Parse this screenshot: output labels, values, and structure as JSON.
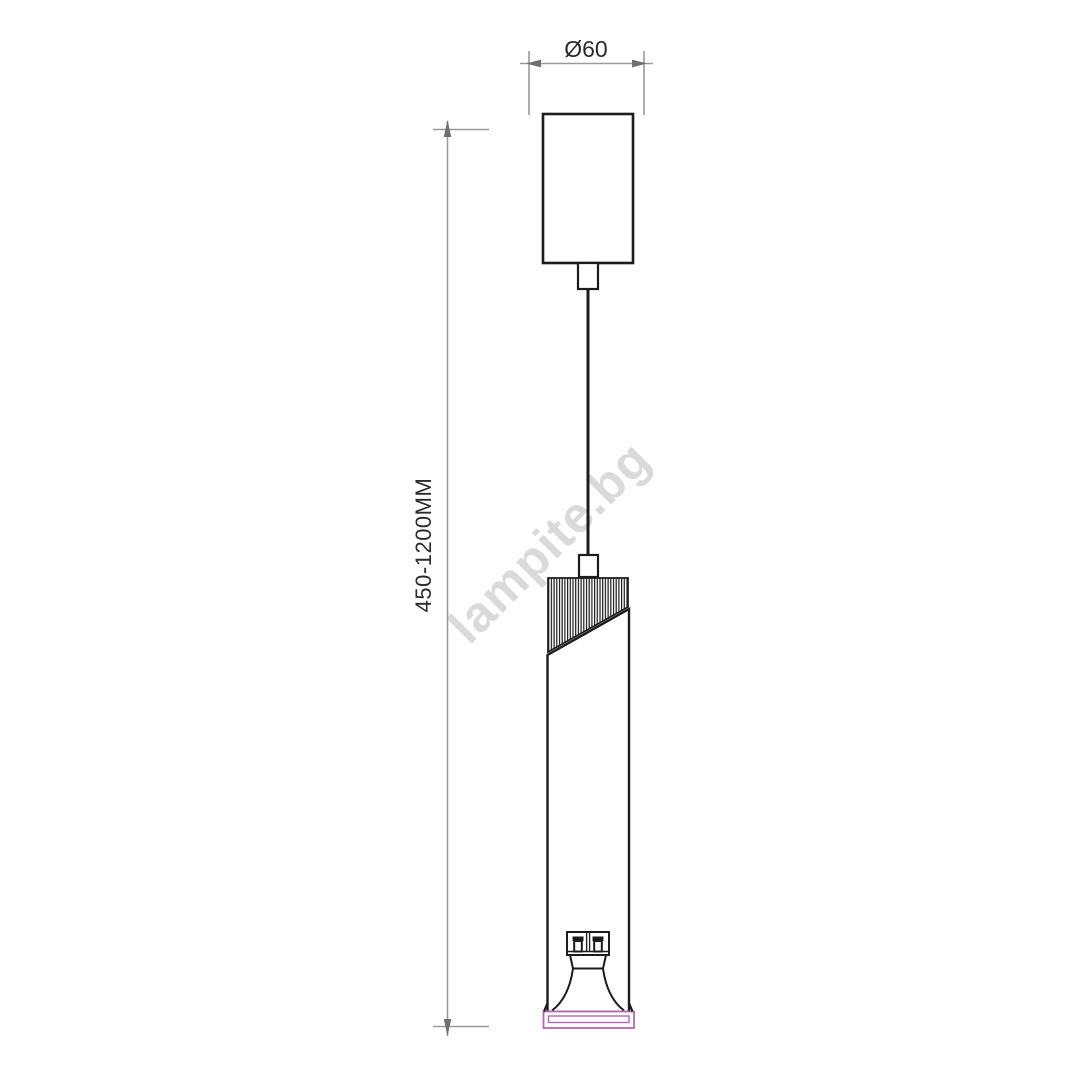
{
  "drawing": {
    "watermark": "lampite.bg",
    "dimensions": {
      "diameter": "Ø60",
      "height_range": "450-1200MM"
    },
    "colors": {
      "line": "#1c1c1c",
      "dimension_line": "#9a9a9a",
      "dimension_arrow": "#6f6f6f",
      "dimension_text": "#2b2b2b",
      "rim_accent": "#b468b4",
      "watermark": "#d9dad9",
      "background": "#ffffff"
    }
  }
}
